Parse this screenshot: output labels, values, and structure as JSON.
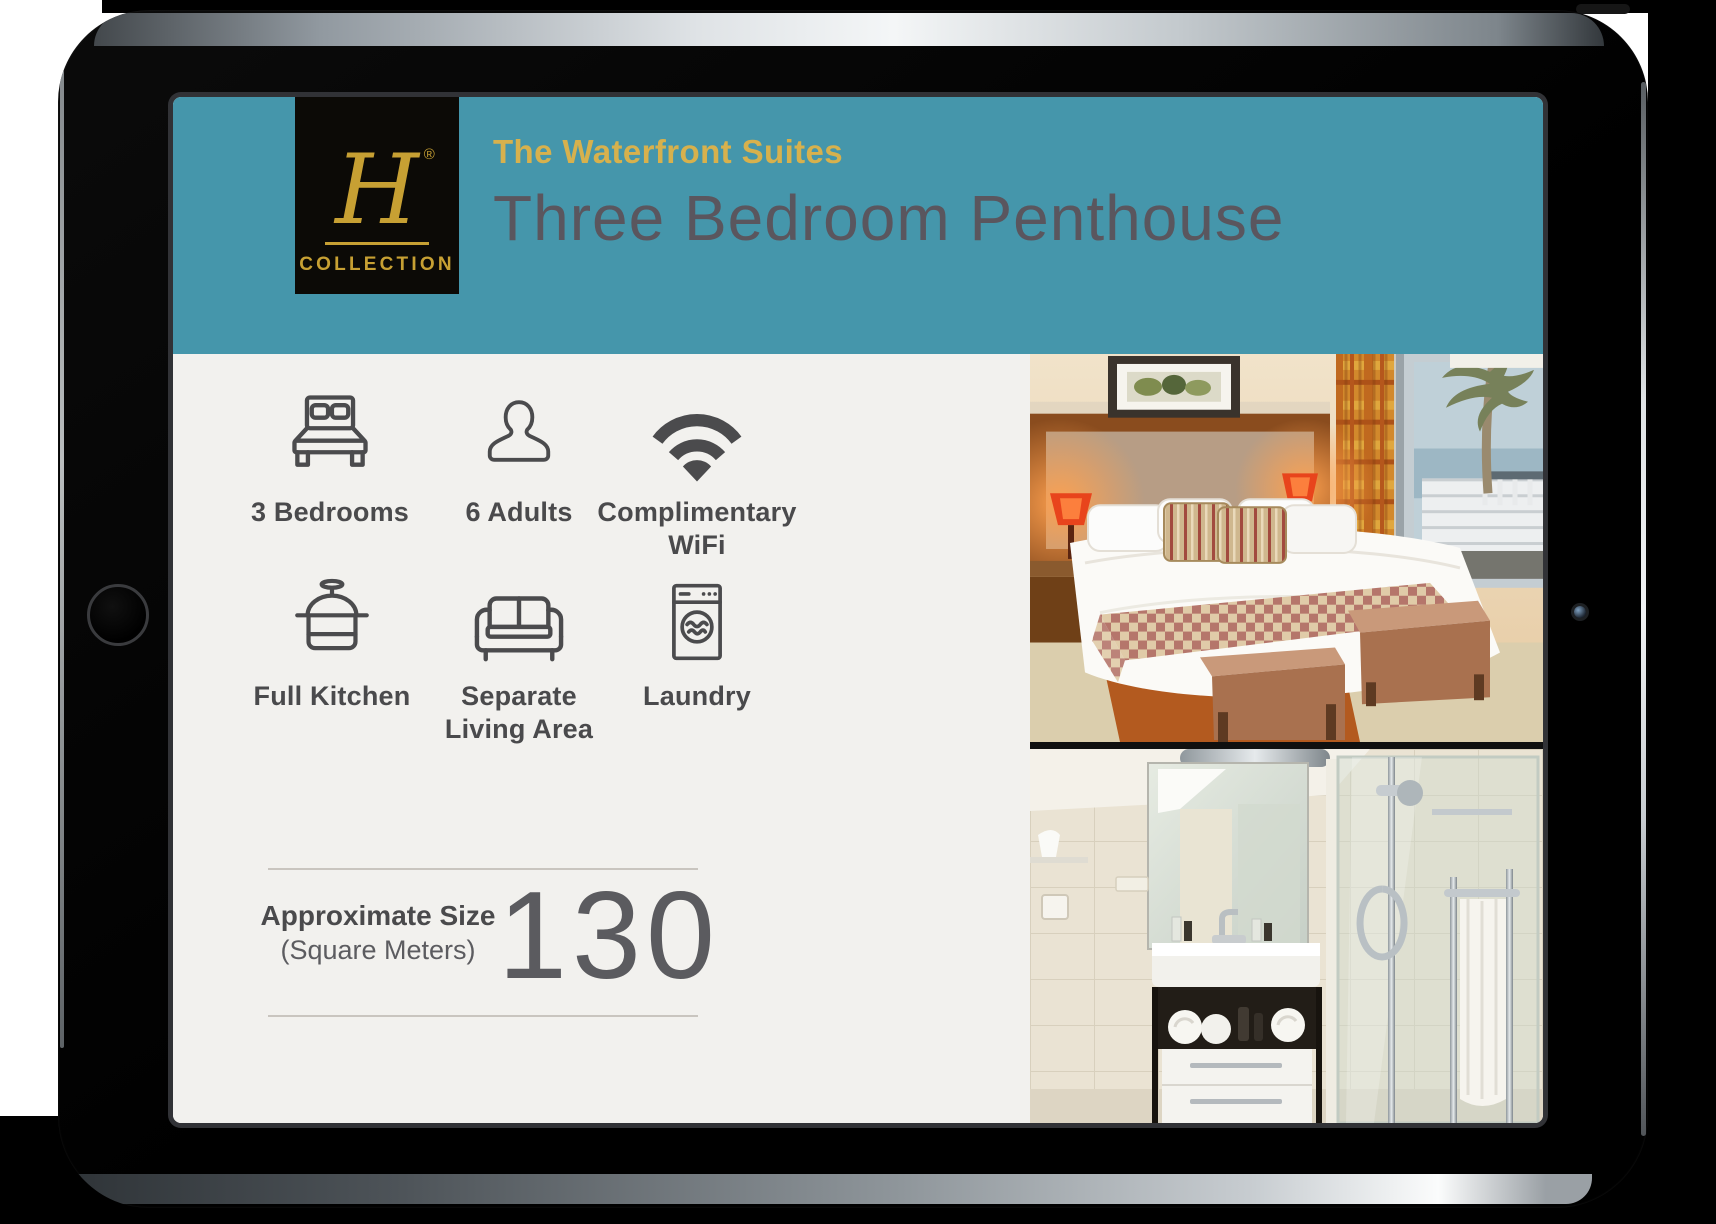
{
  "header": {
    "logo": {
      "monogram": "H",
      "registered": "®",
      "word": "COLLECTION"
    },
    "subtitle": "The Waterfront Suites",
    "title": "Three Bedroom Penthouse"
  },
  "amenities": [
    {
      "icon": "bed-icon",
      "label": "3 Bedrooms"
    },
    {
      "icon": "person-icon",
      "label": "6 Adults"
    },
    {
      "icon": "wifi-icon",
      "label": "Complimentary WiFi"
    },
    {
      "icon": "pot-icon",
      "label": "Full Kitchen"
    },
    {
      "icon": "sofa-icon",
      "label": "Separate Living Area"
    },
    {
      "icon": "washer-icon",
      "label": "Laundry"
    }
  ],
  "size": {
    "label": "Approximate Size",
    "unit": "(Square Meters)",
    "value": "130"
  },
  "photos": [
    {
      "name": "bedroom-photo"
    },
    {
      "name": "bathroom-photo"
    }
  ],
  "colors": {
    "header_teal": "#4596ab",
    "gold": "#d7b14d",
    "logo_gold": "#c7a033",
    "title_gray": "#5a565e",
    "panel_bg": "#f2f1ee",
    "icon_gray": "#4b4b4d"
  }
}
